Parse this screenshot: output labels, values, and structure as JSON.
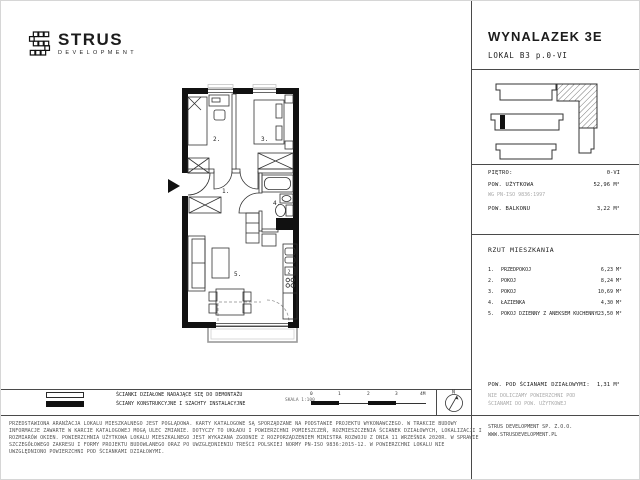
{
  "logo": {
    "brand": "STRUS",
    "subtitle": "DEVELOPMENT"
  },
  "header": {
    "title": "WYNALAZEK 3E",
    "subtitle": "LOKAL B3 p.0-VI"
  },
  "details": {
    "floor_label": "PIĘTRO:",
    "floor_value": "0-VI",
    "area_label": "POW. UŻYTKOWA",
    "area_value": "52,96 M²",
    "area_norm": "WG PN-ISO 9836:1997",
    "balcony_label": "POW. BALKONU",
    "balcony_value": "3,22 M²"
  },
  "rooms": {
    "title": "RZUT MIESZKANIA",
    "items": [
      {
        "no": "1.",
        "name": "PRZEDPOKÓJ",
        "area": "6,23 M²"
      },
      {
        "no": "2.",
        "name": "POKÓJ",
        "area": "8,24 M²"
      },
      {
        "no": "3.",
        "name": "POKÓJ",
        "area": "10,69 M²"
      },
      {
        "no": "4.",
        "name": "ŁAZIENKA",
        "area": "4,30 M²"
      },
      {
        "no": "5.",
        "name": "POKÓJ DZIENNY Z ANEKSEM KUCHENNYM",
        "area": "23,50 M²"
      }
    ]
  },
  "partition": {
    "label": "POW. POD ŚCIANAMI DZIAŁOWYMI:",
    "value": "1,31 M²",
    "note_line1": "NIE DOLICZAMY POWIERZCHNI POD",
    "note_line2": "ŚCIANAMI DO POW. UŻYTKOWEJ"
  },
  "legend": {
    "items": [
      {
        "swatch": "outline",
        "label": "ŚCIANKI DZIAŁOWE NADAJĄCE SIĘ DO DEMONTAŻU"
      },
      {
        "swatch": "solid",
        "label": "ŚCIANY KONSTRUKCYJNE I SZACHTY INSTALACYJNE"
      }
    ]
  },
  "scalebar": {
    "label": "SKALA 1:100",
    "ticks": [
      "0",
      "1",
      "2",
      "3",
      "4M"
    ]
  },
  "compass": {
    "north": "N"
  },
  "plan": {
    "labels": {
      "hall": "1.",
      "room2": "2.",
      "room3": "3.",
      "bath": "4.",
      "living": "5."
    },
    "stove_label": "2"
  },
  "disclaimer": {
    "lines": [
      "PRZEDSTAWIONA ARANŻACJA LOKALU MIESZKALNEGO JEST POGLĄDOWA. KARTY KATALOGOWE SĄ SPORZĄDZANE NA PODSTAWIE PROJEKTU WYKONAWCZEGO. W TRAKCIE BUDOWY",
      "INFORMACJE ZAWARTE W KARCIE KATALOGOWEJ MOGĄ ULEC ZMIANIE. DOTYCZY TO UKŁADU I POWIERZCHNI POMIESZCZEŃ, ROZMIESZCZENIA ŚCIANEK DZIAŁOWYCH, LOKALIZACJI I",
      "ROZMIARÓW OKIEN. POWIERZCHNIA UŻYTKOWA LOKALU MIESZKALNEGO JEST WYKAZANA ZGODNIE Z ROZPORZĄDZENIEM MINISTRA ROZWOJU Z DNIA 11 WRZEŚNIA 2020R. W SPRAWIE",
      "SZCZEGÓŁOWEGO ZAKRESU I FORMY PROJEKTU BUDOWLANEGO ORAZ PO UWZGLĘDNIENIU TREŚCI POLSKIEJ NORMY PN-ISO 9836:2015-12. W POWIERZCHNI LOKALU NIE",
      "UWZGLĘDNIONO POWIERZCHNI POD ŚCIANKAMI DZIAŁOWYMI."
    ]
  },
  "footer": {
    "company": "STRUS DEVELOPMENT SP. Z.O.O.",
    "website": "WWW.STRUSDEVELOPMENT.PL"
  }
}
